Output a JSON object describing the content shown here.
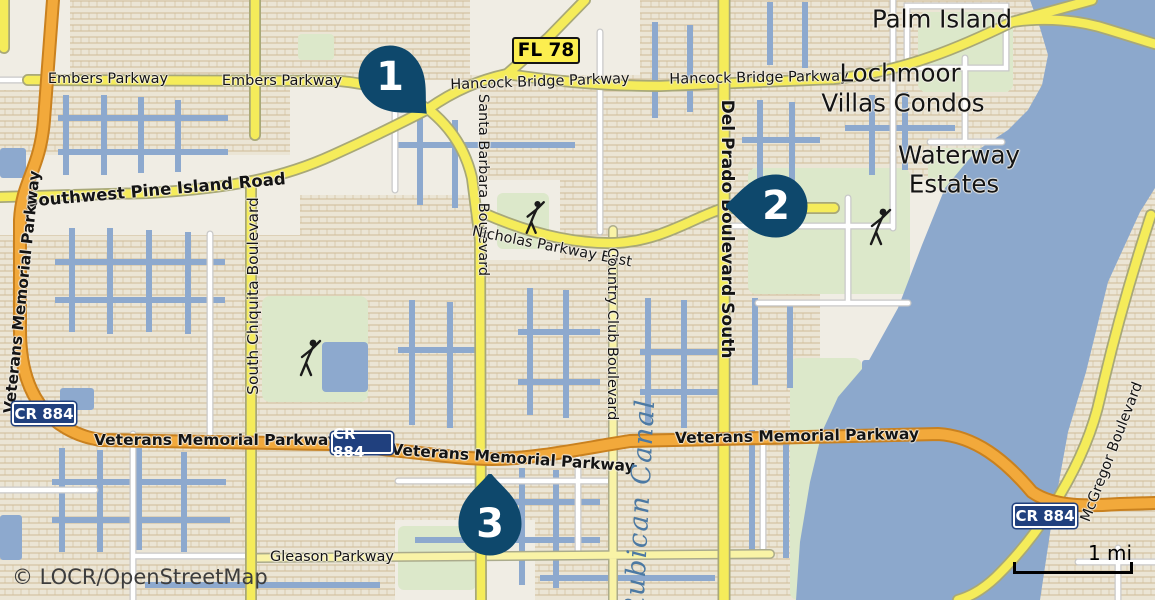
{
  "map": {
    "attribution": "© LOCR/OpenStreetMap",
    "scale": {
      "label": "1 mi"
    },
    "markers": [
      {
        "label": "1"
      },
      {
        "label": "2"
      },
      {
        "label": "3"
      }
    ],
    "shields": {
      "fl_78": "FL 78",
      "cr_884": "CR 884"
    },
    "place_labels": {
      "palm_island": "Palm Island",
      "lochmoor_line1": "Lochmoor",
      "lochmoor_line2": "Villas Condos",
      "waterway_line1": "Waterway",
      "waterway_line2": "Estates"
    },
    "road_labels": {
      "embers": "Embers Parkway",
      "hancock": "Hancock Bridge Parkway",
      "sw_pine_island": "Southwest Pine Island Road",
      "veterans": "Veterans Memorial Parkway",
      "south_chiquita": "South Chiquita Boulevard",
      "santa_barbara": "Santa Barbara Boulevard",
      "nicholas": "Nicholas Parkway East",
      "country_club": "Country Club Boulevard",
      "del_prado": "Del Prado Boulevard South",
      "gleason": "Gleason Parkway",
      "mcgregor": "McGregor Boulevard"
    },
    "water_labels": {
      "rubican": "Rubican Canal"
    },
    "colors": {
      "water": "#8CA8CC",
      "canal": "#8DA9CE",
      "land": "#F0EDE4",
      "block": "#EAE4D2",
      "road_yellow": "#F5EC5A",
      "road_pale_yellow": "#F9F3A6",
      "road_orange": "#F2A93B",
      "green_area": "#DCE8CA",
      "marker": "#0E486C",
      "shield_blue": "#20407E",
      "shield_yellow": "#FCEE4F"
    }
  }
}
